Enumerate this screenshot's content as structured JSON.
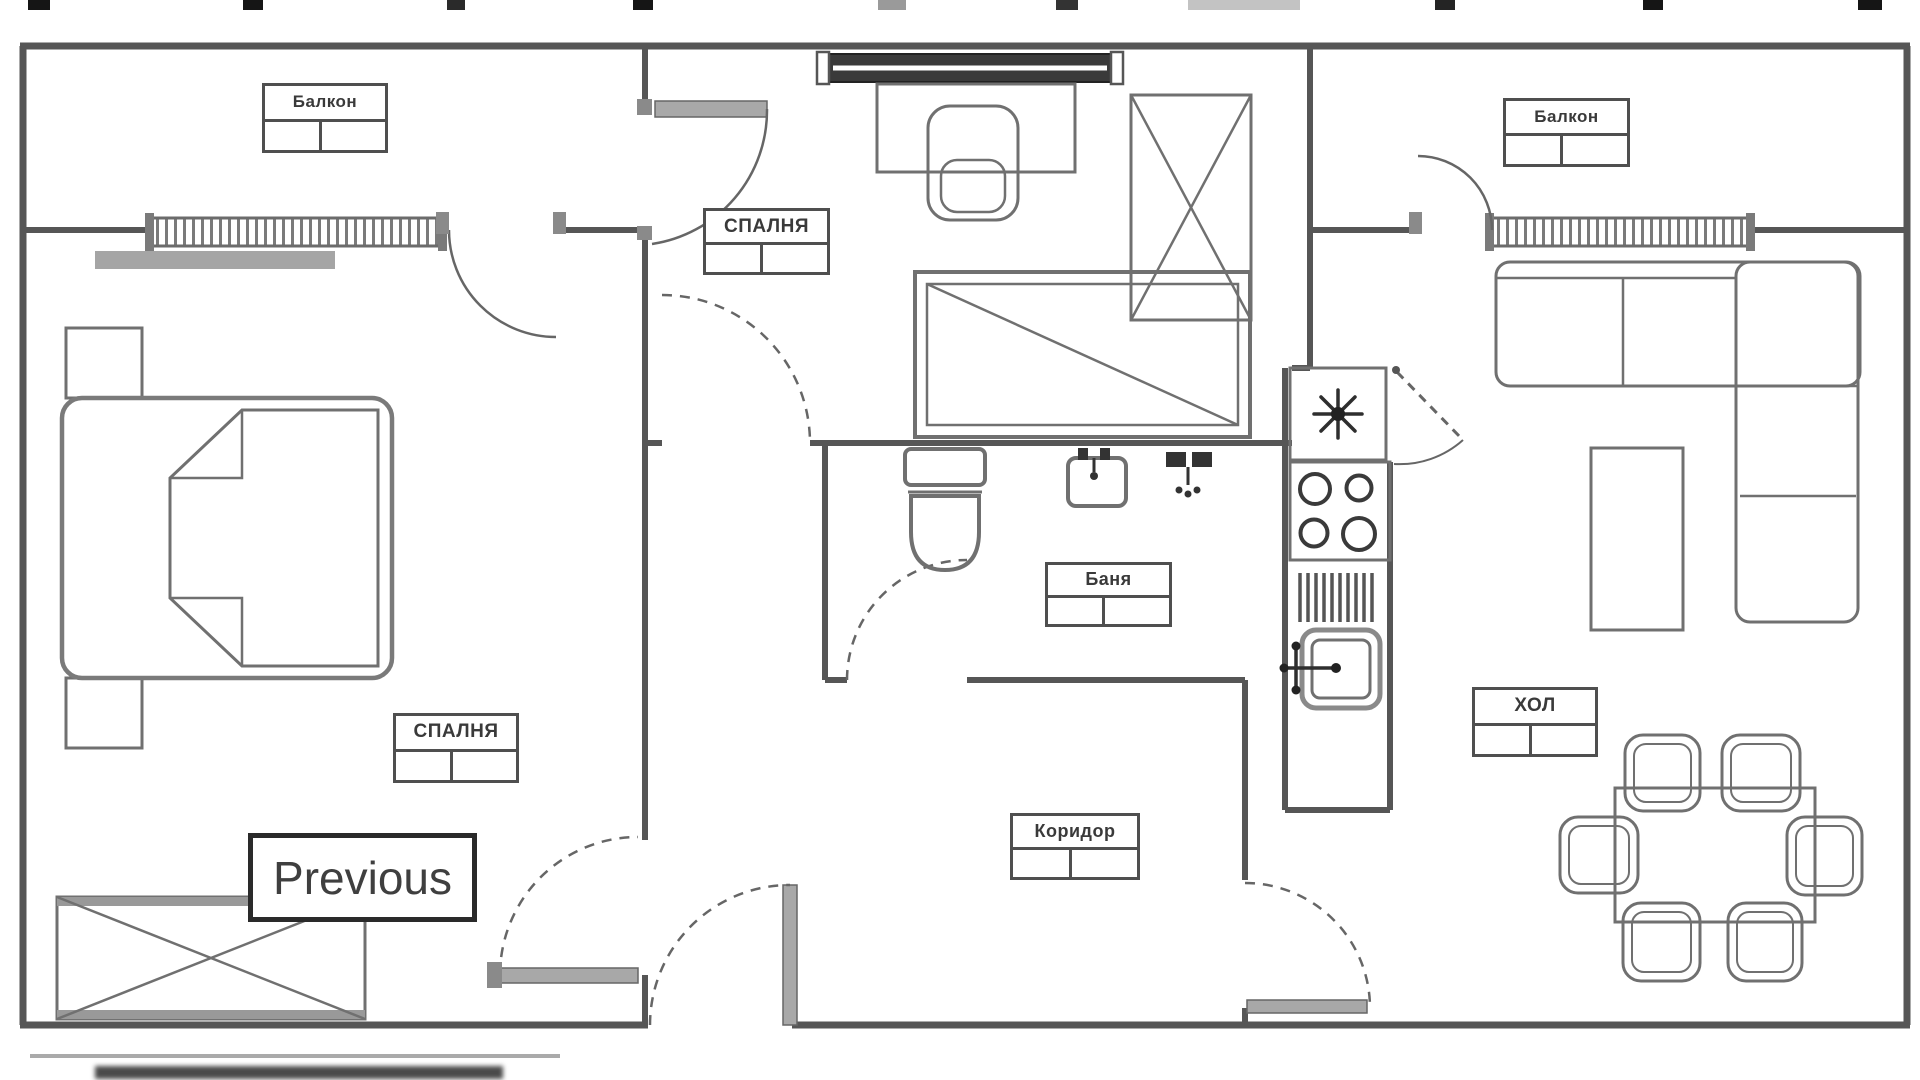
{
  "overlay": {
    "previous_label": "Previous"
  },
  "labels": {
    "balcony_left": "Балкон",
    "bedroom_mid": "СПАЛНЯ",
    "balcony_right": "Балкон",
    "bathroom": "Баня",
    "bedroom_left": "СПАЛНЯ",
    "living_room": "ХОЛ",
    "corridor": "Коридор"
  },
  "icons": {
    "fridge_symbol": "snowflake-icon",
    "stove_symbol": "four-burners-icon",
    "sink_symbol": "sink-faucet-icon"
  },
  "colors": {
    "wall": "#565656",
    "furniture": "#707070",
    "label_border": "#4f4f4f",
    "text": "#3a3a3a",
    "window_dark": "#3a3a3a",
    "door_leaf": "#a8a8a8"
  }
}
